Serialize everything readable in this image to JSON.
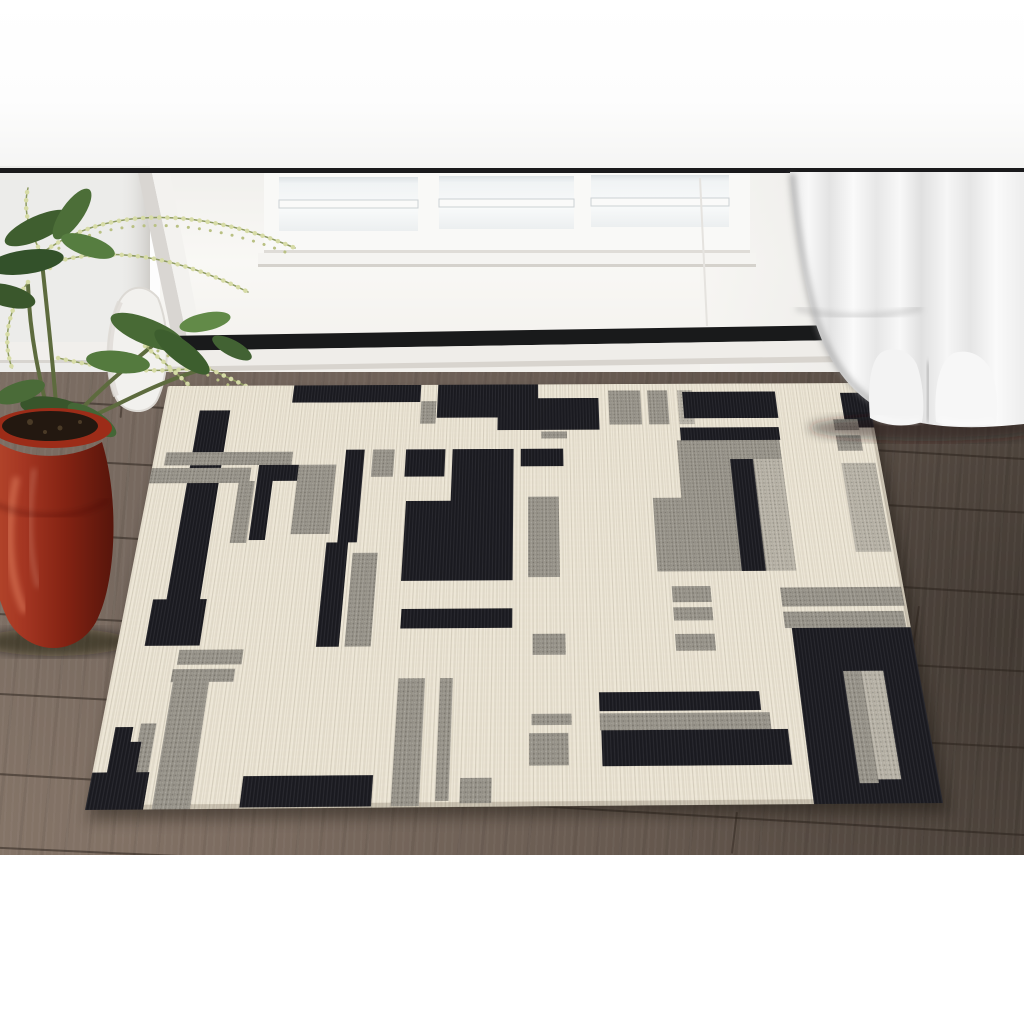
{
  "scene": {
    "description": "Product photo of a cream, black and gray abstract color-block area rug staged on a dark brown wood plank floor in front of a white entry door with a three-pane window, a sheer white curtain on the right and a leafy plant in a red glazed pot on the left",
    "objects": [
      "white wall",
      "black door-frame trim line",
      "white entry door",
      "door window with 3 panes",
      "white threshold",
      "dark wood plank floor",
      "abstract color-block area rug",
      "green plant with pale bud strings",
      "red glazed ceramic pot",
      "white vase",
      "sheer white curtain"
    ],
    "window_pane_count": 3
  },
  "palette": {
    "wall": "#fdfdfd",
    "trim_line": "#1a1a1c",
    "door": "#f6f5f2",
    "glass": "#f2f5f6",
    "threshold": "#efede9",
    "floor": "#6a5d53",
    "rug_base": "#ece5d4",
    "rug_black": "#1b1b21",
    "rug_gray": "#98948a",
    "rug_gray_light": "#b8b3a7",
    "pot_red": "#a03320",
    "soil": "#231810",
    "leaf_green": "#486a35",
    "bud_yellow": "#d6dba6",
    "curtain": "#f2f2f2"
  },
  "rug": {
    "w": 700,
    "h": 425,
    "blocks": [
      [
        126,
        0,
        127,
        21,
        "k"
      ],
      [
        270,
        0,
        100,
        40,
        "k"
      ],
      [
        330,
        17,
        100,
        38,
        "k"
      ],
      [
        254,
        20,
        15,
        27,
        "g"
      ],
      [
        440,
        8,
        32,
        41,
        "g"
      ],
      [
        479,
        8,
        20,
        41,
        "g"
      ],
      [
        509,
        8,
        15,
        41,
        "gl"
      ],
      [
        514,
        10,
        93,
        32,
        "k"
      ],
      [
        509,
        53,
        97,
        15,
        "k"
      ],
      [
        672,
        12,
        28,
        42,
        "k"
      ],
      [
        661,
        44,
        24,
        13,
        "g"
      ],
      [
        661,
        63,
        24,
        18,
        "g"
      ],
      [
        662,
        95,
        33,
        97,
        "gl"
      ],
      [
        505,
        68,
        100,
        143,
        "g"
      ],
      [
        478,
        133,
        27,
        78,
        "g"
      ],
      [
        555,
        90,
        22,
        121,
        "k"
      ],
      [
        578,
        90,
        27,
        121,
        "gl"
      ],
      [
        36,
        30,
        30,
        220,
        "k"
      ],
      [
        11,
        79,
        122,
        15,
        "g"
      ],
      [
        0,
        97,
        95,
        17,
        "g"
      ],
      [
        102,
        94,
        43,
        18,
        "k"
      ],
      [
        102,
        112,
        15,
        64,
        "k"
      ],
      [
        85,
        112,
        15,
        67,
        "g"
      ],
      [
        140,
        94,
        36,
        76,
        "g"
      ],
      [
        184,
        77,
        18,
        102,
        "k"
      ],
      [
        174,
        179,
        20,
        104,
        "k"
      ],
      [
        199,
        190,
        23,
        93,
        "g"
      ],
      [
        210,
        77,
        21,
        31,
        "g"
      ],
      [
        242,
        77,
        38,
        31,
        "k"
      ],
      [
        287,
        77,
        59,
        142,
        "k"
      ],
      [
        245,
        135,
        101,
        84,
        "k"
      ],
      [
        353,
        77,
        41,
        20,
        "k"
      ],
      [
        373,
        57,
        25,
        8,
        "g"
      ],
      [
        360,
        131,
        29,
        85,
        "g"
      ],
      [
        490,
        226,
        35,
        16,
        "g"
      ],
      [
        490,
        247,
        35,
        13,
        "g"
      ],
      [
        490,
        273,
        35,
        16,
        "g"
      ],
      [
        588,
        228,
        110,
        19,
        "g"
      ],
      [
        588,
        252,
        108,
        16,
        "g"
      ],
      [
        594,
        268,
        106,
        157,
        "k"
      ],
      [
        634,
        309,
        16,
        99,
        "g"
      ],
      [
        650,
        309,
        19,
        96,
        "gl"
      ],
      [
        24,
        236,
        48,
        45,
        "k"
      ],
      [
        55,
        285,
        56,
        14,
        "g"
      ],
      [
        52,
        303,
        54,
        12,
        "g"
      ],
      [
        54,
        312,
        31,
        113,
        "g"
      ],
      [
        12,
        355,
        15,
        69,
        "k"
      ],
      [
        33,
        352,
        13,
        73,
        "g"
      ],
      [
        0,
        394,
        47,
        31,
        "k"
      ],
      [
        27,
        368,
        9,
        43,
        "k"
      ],
      [
        125,
        398,
        107,
        26,
        "k"
      ],
      [
        247,
        247,
        99,
        19,
        "k"
      ],
      [
        364,
        272,
        29,
        20,
        "g"
      ],
      [
        248,
        313,
        23,
        111,
        "g"
      ],
      [
        284,
        313,
        11,
        107,
        "g"
      ],
      [
        304,
        401,
        26,
        21,
        "g"
      ],
      [
        363,
        346,
        34,
        10,
        "g"
      ],
      [
        361,
        363,
        33,
        28,
        "g"
      ],
      [
        421,
        327,
        138,
        17,
        "k"
      ],
      [
        421,
        346,
        145,
        15,
        "g"
      ],
      [
        422,
        361,
        158,
        31,
        "k"
      ]
    ]
  },
  "floor": {
    "seams": [
      {
        "x": -20,
        "y": 396,
        "len": 1080,
        "rot": 3.4
      },
      {
        "x": -20,
        "y": 455,
        "len": 1080,
        "rot": 3.1
      },
      {
        "x": -20,
        "y": 528,
        "len": 1080,
        "rot": 3.6
      },
      {
        "x": -20,
        "y": 612,
        "len": 1080,
        "rot": 3.2
      },
      {
        "x": -20,
        "y": 692,
        "len": 1080,
        "rot": 3.0
      },
      {
        "x": -20,
        "y": 772,
        "len": 1080,
        "rot": 3.4
      },
      {
        "x": -20,
        "y": 846,
        "len": 1080,
        "rot": 2.6
      }
    ],
    "joints": [
      {
        "x": 736,
        "y": 812,
        "len": 42,
        "rot": 7
      },
      {
        "x": 285,
        "y": 468,
        "len": 34,
        "rot": 5
      },
      {
        "x": 918,
        "y": 606,
        "len": 46,
        "rot": 8
      },
      {
        "x": 122,
        "y": 390,
        "len": 28,
        "rot": 5
      }
    ]
  }
}
